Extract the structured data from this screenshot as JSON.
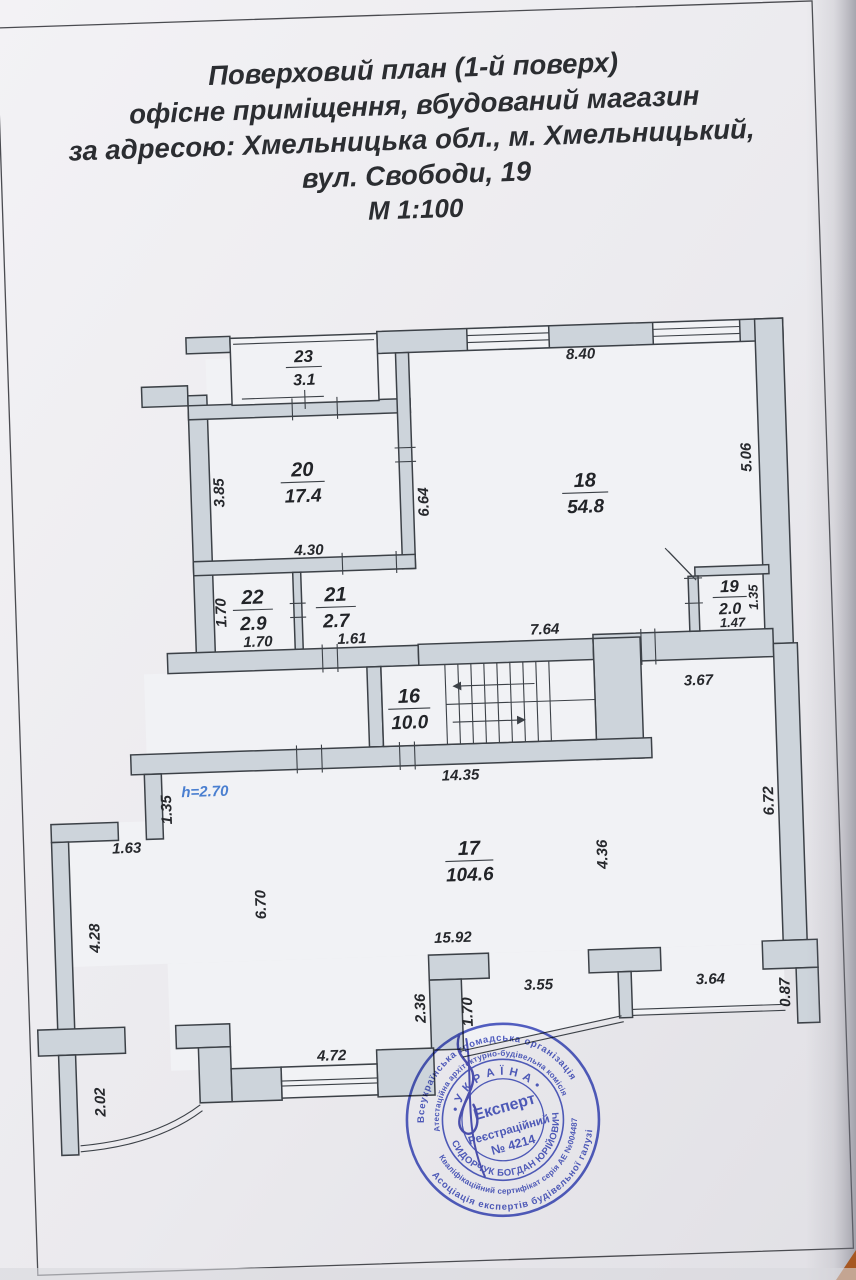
{
  "document": {
    "title_lines": [
      "Поверховий план (1-й поверх)",
      "офісне приміщення, вбудований магазин",
      "за адресою: Хмельницька обл., м. Хмельницький,",
      "вул. Свободи, 19",
      "М 1:100"
    ]
  },
  "plan": {
    "rooms": {
      "r16": {
        "number": "16",
        "area": "10.0"
      },
      "r17": {
        "number": "17",
        "area": "104.6"
      },
      "r18": {
        "number": "18",
        "area": "54.8"
      },
      "r19": {
        "number": "19",
        "area": "2.0"
      },
      "r20": {
        "number": "20",
        "area": "17.4"
      },
      "r21": {
        "number": "21",
        "area": "2.7"
      },
      "r22": {
        "number": "22",
        "area": "2.9"
      },
      "r23": {
        "number": "23",
        "area": "3.1"
      }
    },
    "dims": {
      "w840": "8.40",
      "w385": "3.85",
      "w664": "6.64",
      "w506": "5.06",
      "w430": "4.30",
      "w170a": "1.70",
      "w170b": "1.70",
      "w161": "1.61",
      "w764": "7.64",
      "w147": "1.47",
      "w135a": "1.35",
      "w1435": "14.35",
      "w367": "3.67",
      "w135b": "1.35",
      "w163": "1.63",
      "w428": "4.28",
      "w670": "6.70",
      "w436": "4.36",
      "w672": "6.72",
      "w1592": "15.92",
      "w236": "2.36",
      "w170c": "1.70",
      "w355": "3.55",
      "w364": "3.64",
      "w087": "0.87",
      "w472": "4.72",
      "w202": "2.02"
    },
    "height_note": "h=2.70"
  },
  "stamp": {
    "outer_top": "Всеукраїнська громадська організація",
    "outer_bottom": "Асоціація експертів будівельної галузі",
    "ring_top": "Атестаційна архітектурно-будівельна комісія",
    "ring_bottom": "Кваліфікаційний сертифікат серія АЕ №004487",
    "country": "• У К Р А Ї Н А •",
    "name": "СИДОРЧУК  БОГДАН  ЮРІЙОВИЧ",
    "role": "Експерт",
    "reg_label": "Реєстраційний",
    "reg_number": "№ 4214"
  },
  "colors": {
    "wall_fill": "#cdd4db",
    "line": "#3c4147",
    "stamp_blue": "#3444bd",
    "note_blue": "#4a7fd0"
  }
}
